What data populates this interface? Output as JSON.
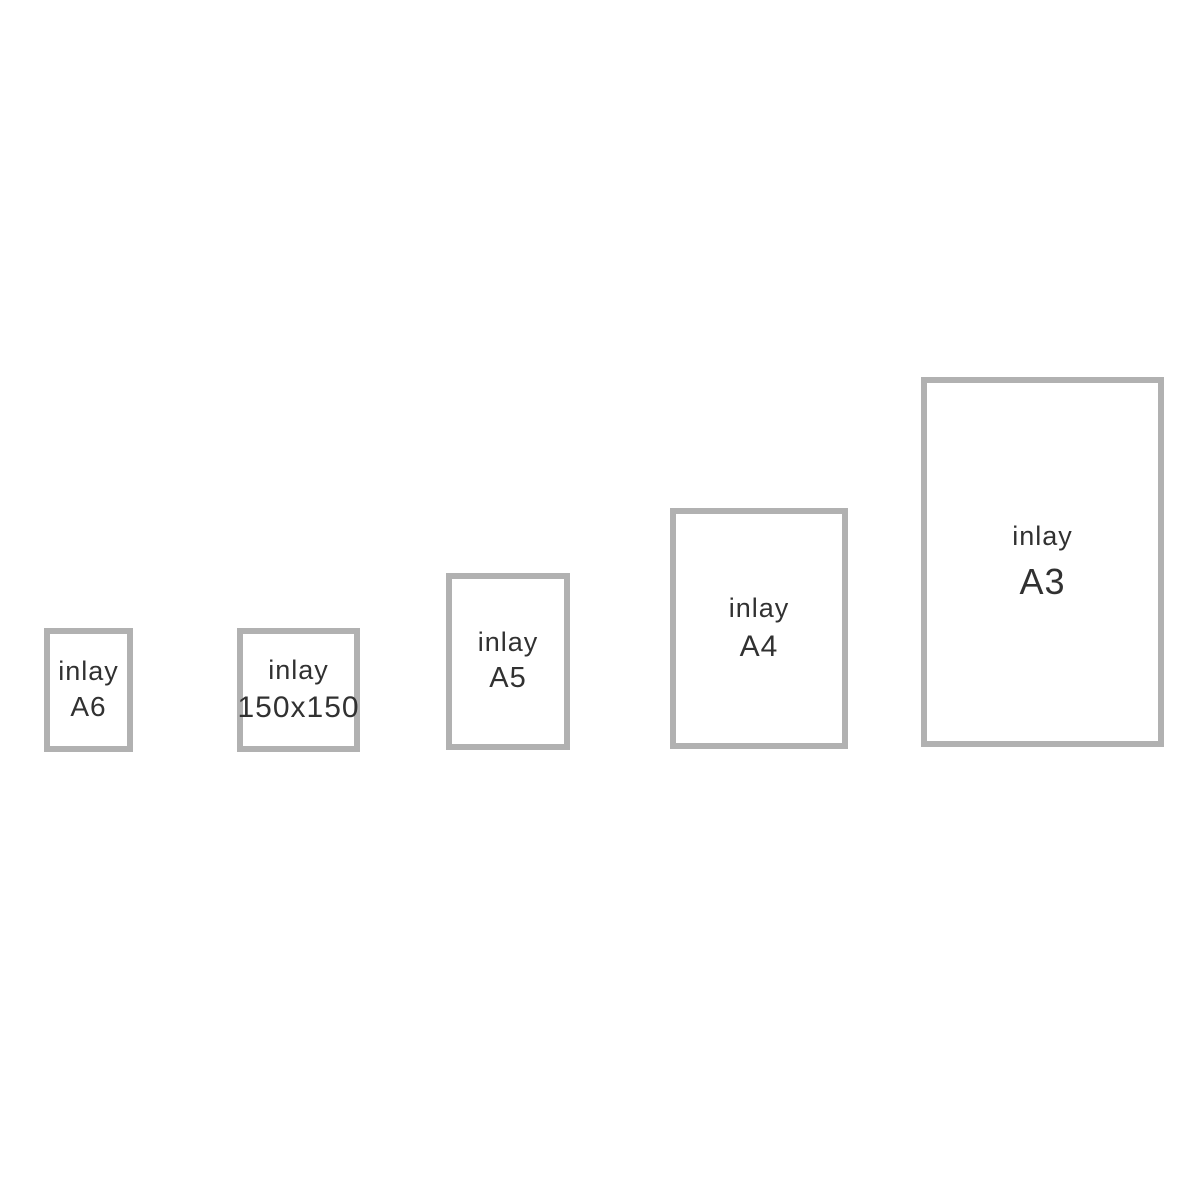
{
  "style": {
    "background": "#ffffff",
    "border_color": "#b1b1b1",
    "text_color": "#313131"
  },
  "diagram": {
    "description_visible_text_only": "",
    "inlays": [
      {
        "label": "inlay",
        "size": "A6"
      },
      {
        "label": "inlay",
        "size": "150x150"
      },
      {
        "label": "inlay",
        "size": "A5"
      },
      {
        "label": "inlay",
        "size": "A4"
      },
      {
        "label": "inlay",
        "size": "A3"
      }
    ]
  }
}
